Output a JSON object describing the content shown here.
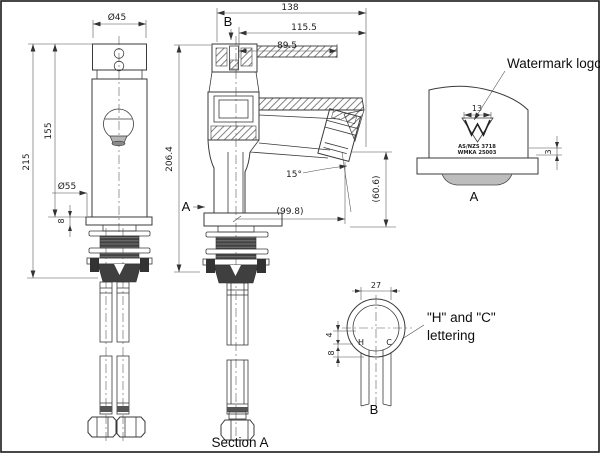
{
  "front_view": {
    "dia_top": "Ø45",
    "height_total": "215",
    "height_body": "155",
    "dia_base": "Ø55",
    "base_thickness": "8"
  },
  "section_view": {
    "width_total": "138",
    "width_upper": "115.5",
    "width_lever": "89.5",
    "height": "206.4",
    "marker_b": "B",
    "marker_a": "A",
    "angle": "15°",
    "reach": "(99.8)",
    "outlet_height": "(60.6)",
    "caption": "Section A"
  },
  "watermark_detail": {
    "callout": "Watermark logo",
    "logo_width": "13",
    "logo_depth": "3",
    "cert_line1": "AS/NZS 3718",
    "cert_line2": "WMKA 25003",
    "view_label": "A"
  },
  "hc_detail": {
    "pipe_dia": "27",
    "offset_top": "4",
    "offset_bottom": "8",
    "hot": "H",
    "cold": "C",
    "callout_line1": "\"H\" and \"C\"",
    "callout_line2": "lettering",
    "view_label": "B"
  }
}
